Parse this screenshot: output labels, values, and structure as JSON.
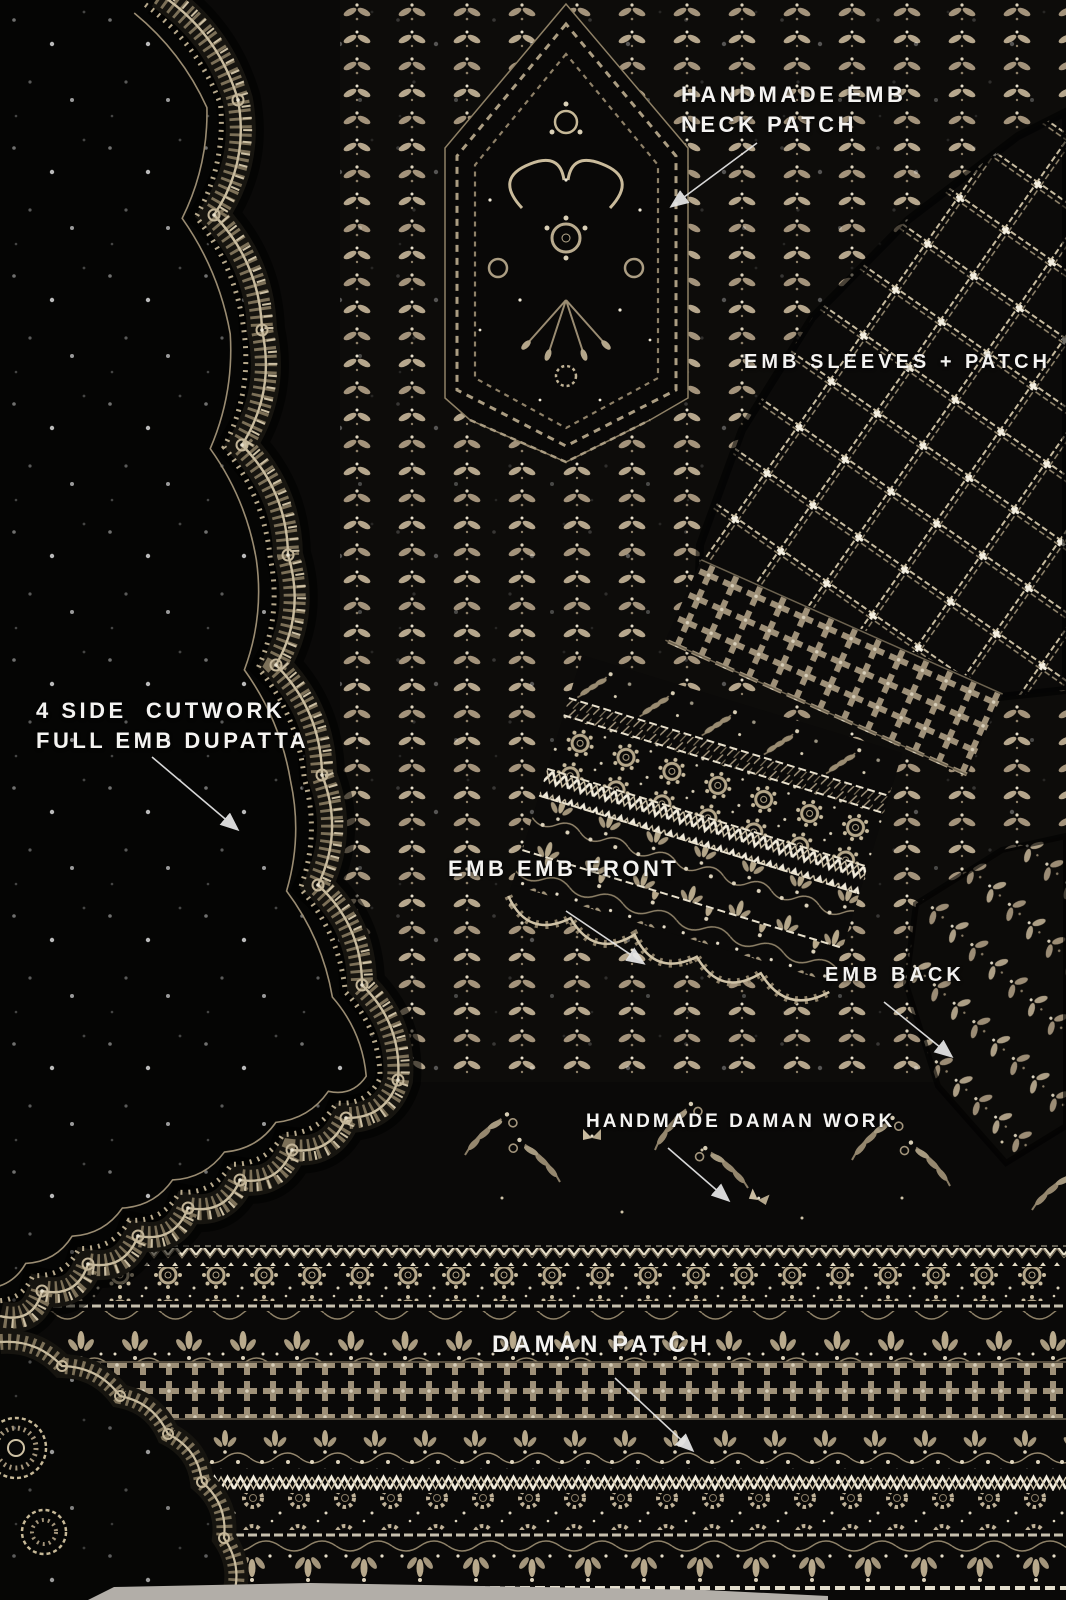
{
  "product_annotations": {
    "neck_patch": "HANDMADE EMB\nNECK PATCH",
    "sleeves": "EMB SLEEVES + PATCH",
    "dupatta": "4 SIDE  CUTWORK\nFULL EMB DUPATTA",
    "front": "EMB EMB FRONT",
    "back": "EMB BACK",
    "daman_work": "HANDMADE DAMAN WORK",
    "daman_patch": "DAMAN PATCH"
  },
  "colors": {
    "background": "#0a0908",
    "embroidery_base": "#a3937b",
    "embroidery_bright": "#d8cdb4",
    "sequin": "#f3eee2",
    "label_text": "#f4f3f1",
    "floor": "#b2aea8"
  }
}
